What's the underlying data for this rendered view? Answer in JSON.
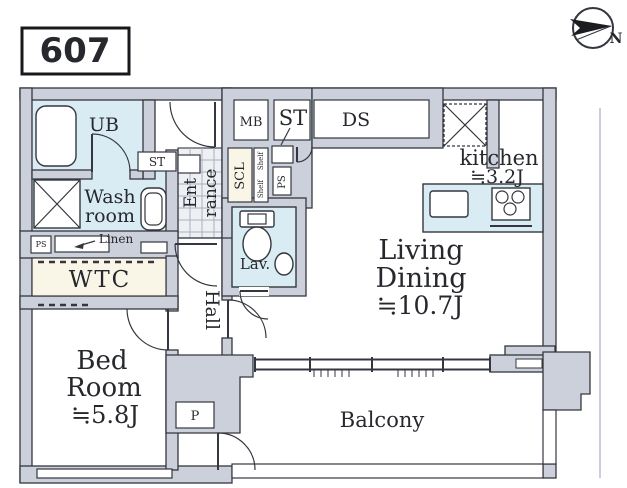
{
  "unit_label": "607",
  "compass": {
    "north": "N"
  },
  "labels": {
    "ub": "UB",
    "wash_line1": "Wash",
    "wash_line2": "room",
    "linen": "Linen",
    "ps_washroom": "PS",
    "st_washroom": "ST",
    "wtc": "WTC",
    "bed_line1": "Bed",
    "bed_line2": "Room",
    "bed_size": "≒5.8J",
    "hall": "Hall",
    "entrance_line1": "Ent",
    "entrance_line2": "rance",
    "st_entrance": "ST",
    "mb": "MB",
    "ds": "DS",
    "scl": "SCL",
    "shelf_line1": "Shelf",
    "shelf_line2": "Shelf",
    "ps_corridor": "PS",
    "lav": "Lav.",
    "kitchen": "kitchen",
    "kitchen_size": "≒3.2J",
    "living_line1": "Living",
    "living_line2": "Dining",
    "living_size": "≒10.7J",
    "balcony": "Balcony",
    "p": "P"
  },
  "colors": {
    "wall": "#ccd0da",
    "outline": "#34373f",
    "wet_room": "#d9ecf4",
    "cream_storage": "#f9f6e7",
    "entrance_tile": "#eef0f4"
  }
}
